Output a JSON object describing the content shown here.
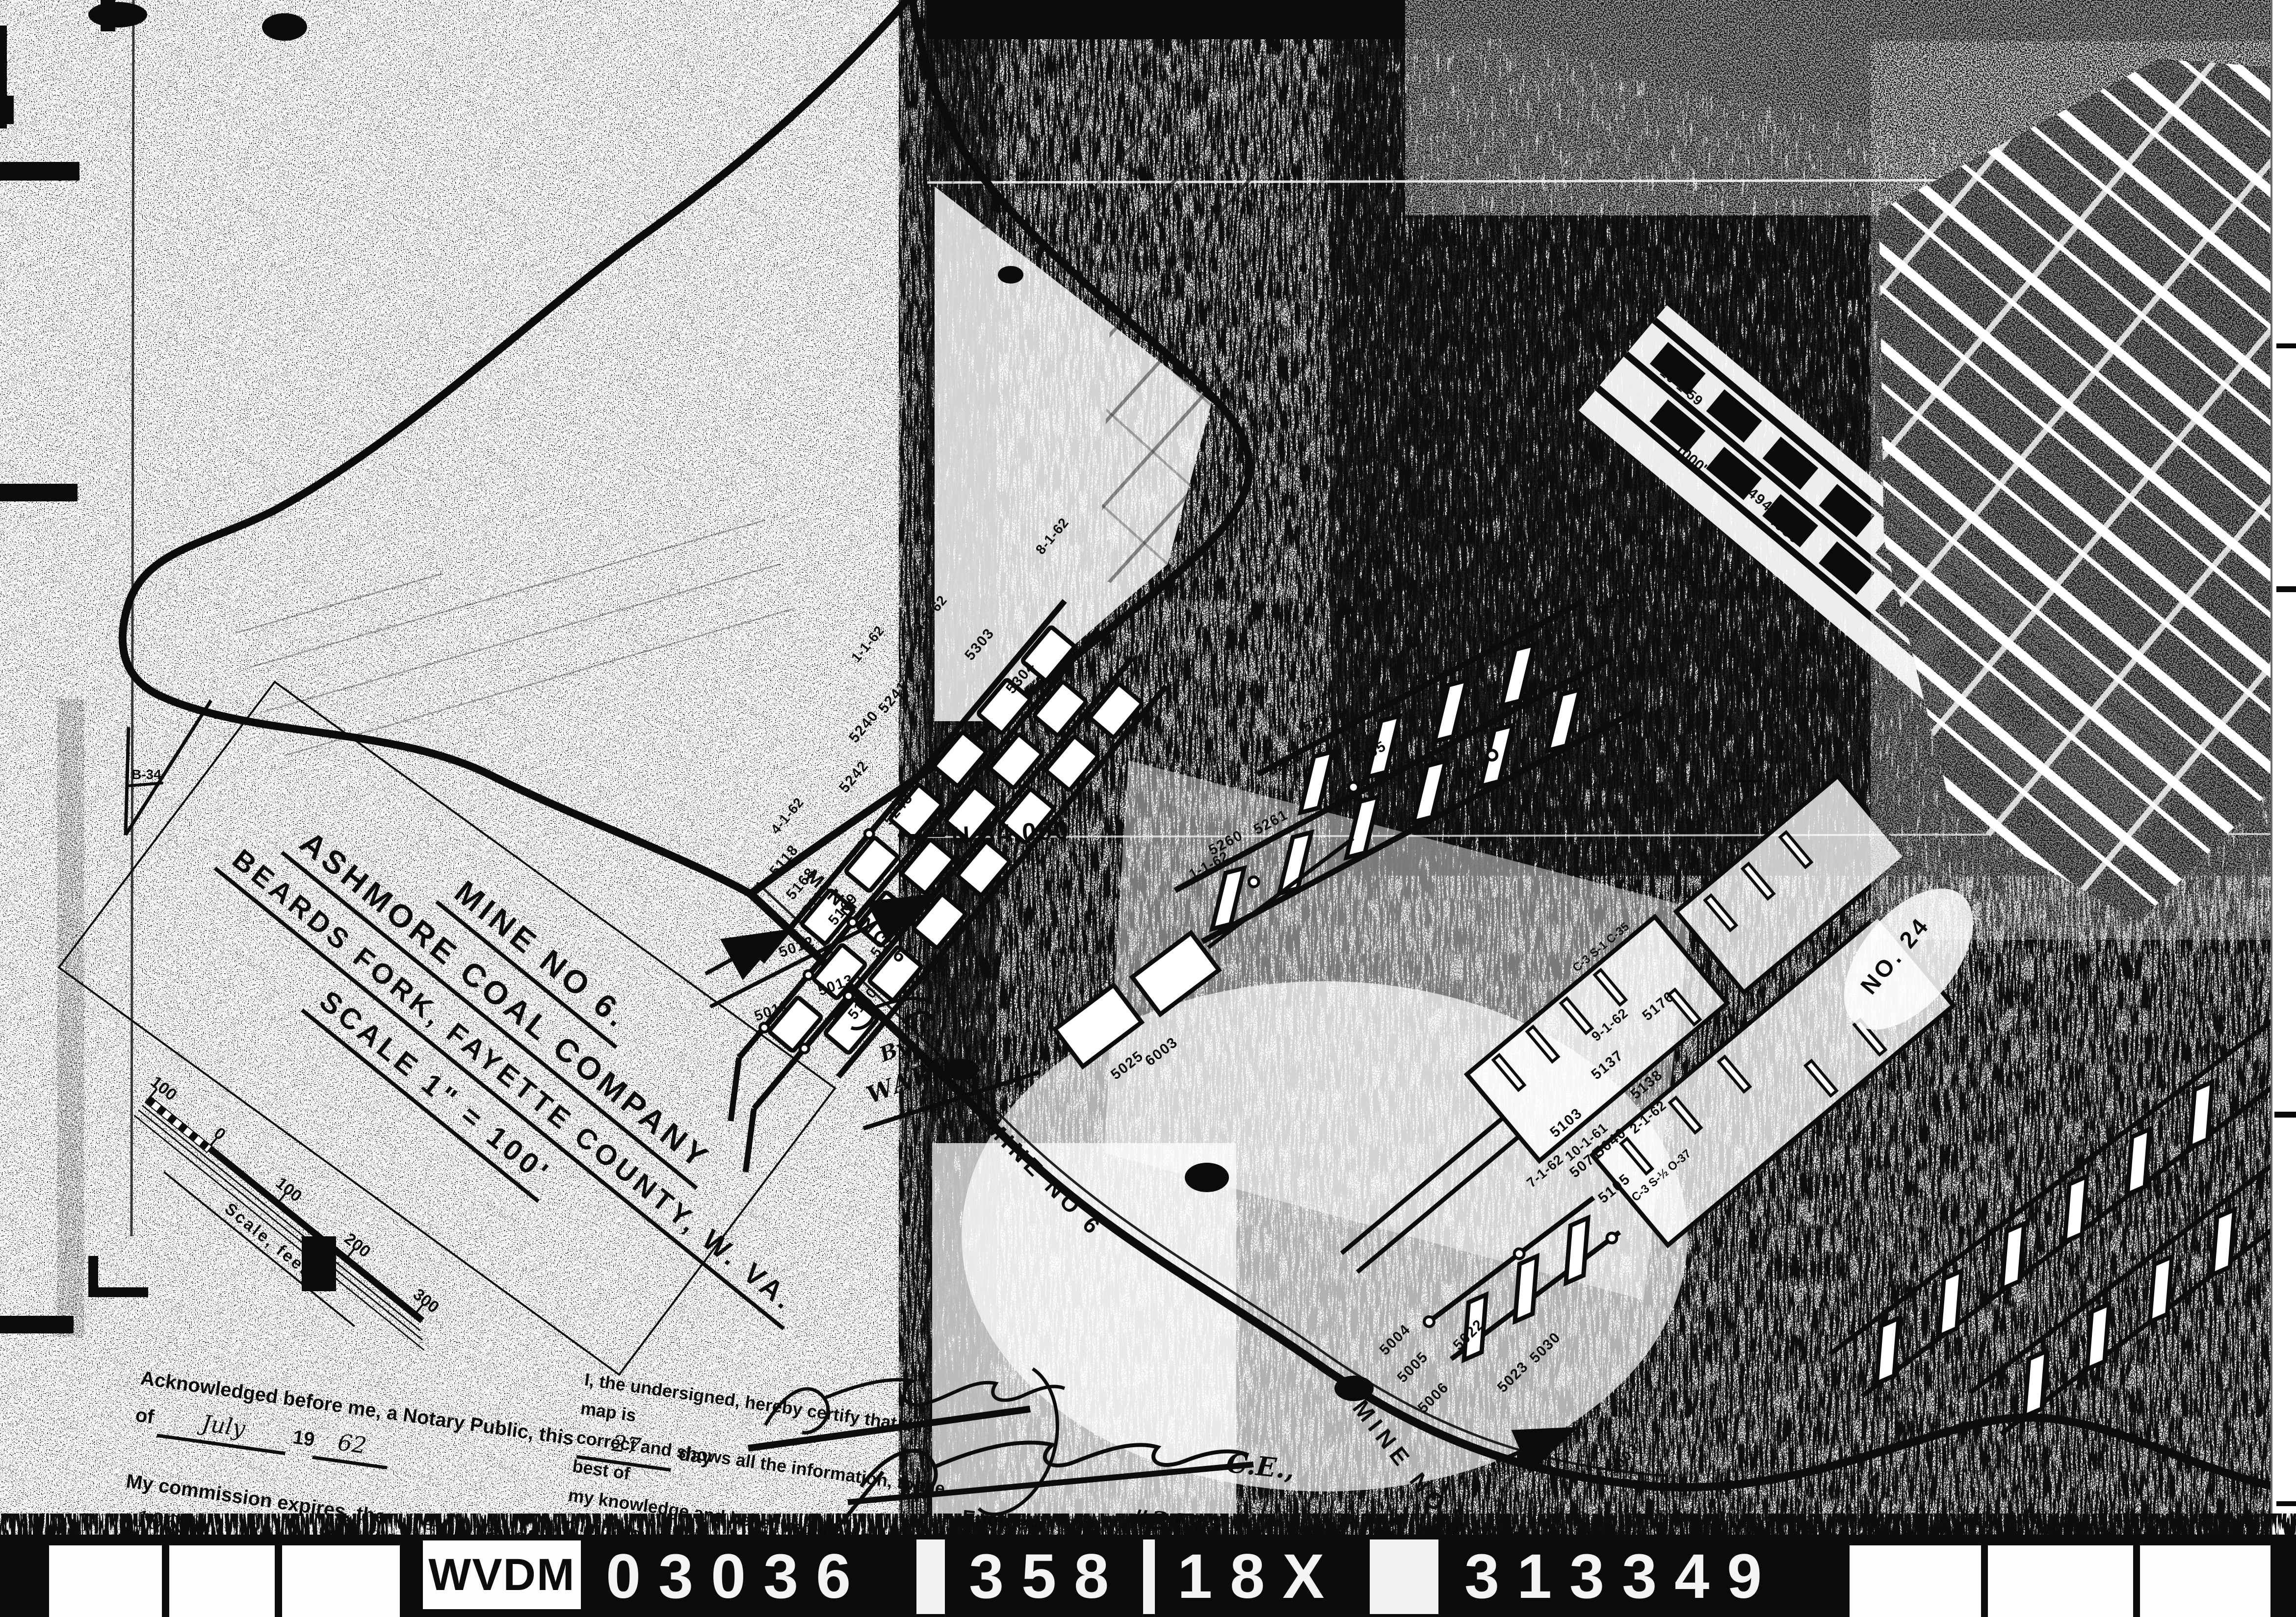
{
  "colors": {
    "ink": "#0b0b0b",
    "paper": "#ffffff"
  },
  "title_block": {
    "lines": [
      "MINE NO 6.",
      "ASHMORE COAL COMPANY",
      "BEARDS FORK, FAYETTE COUNTY, W. VA.",
      "SCALE 1\" = 100'"
    ]
  },
  "scale_bar": {
    "ticks": [
      "100",
      "0",
      "100",
      "200",
      "300"
    ],
    "caption": "Scale, feet"
  },
  "notary": {
    "line1_pre": "Acknowledged before me, a Notary Public, this",
    "day": "27",
    "line1_post": "day",
    "line2_pre": "of",
    "month": "July",
    "year_prefix": "19",
    "year": "62",
    "line3_pre": "My commission expires, the",
    "exp_day": "4",
    "line3_mid": "day of",
    "exp_month": "Dec.",
    "exp_year": "1969"
  },
  "certification": {
    "line1": "I, the undersigned, hereby certify that this map is",
    "line2": "correct and shows all the information, to the best of",
    "line3": "my knowledge and belief, required by the mining laws",
    "line4": "of this State, and covers the period ending",
    "credential": "C.E.,",
    "role": "Engineer",
    "number": "#2135"
  },
  "annotations": {
    "by_ward_line1": "By",
    "by_ward_line2": "WARD",
    "mine6_hand": "MINE NO 6"
  },
  "map_labels": {
    "mine6_haulage": "MINE NO 6",
    "mine5": "MINE NO 5",
    "no24": "NO. 24",
    "northing": "N 34,000",
    "benchmark": "B-34",
    "distance": "1000'"
  },
  "survey_points": [
    "5011",
    "5012",
    "5013",
    "5118",
    "5119",
    "5120",
    "5168",
    "5169",
    "5170",
    "5240",
    "5241",
    "5242",
    "5243",
    "5303",
    "5304",
    "5260",
    "5261",
    "5263",
    "5264",
    "5265",
    "5300",
    "5022",
    "5023",
    "5030",
    "5003",
    "5004",
    "5005",
    "5006",
    "5025",
    "6003",
    "5103",
    "5105",
    "5071",
    "5040",
    "5137",
    "5138",
    "5176",
    "4949",
    "4950"
  ],
  "dates": [
    "1-1-62",
    "4-1-62",
    "8-1-62",
    "9-1-62",
    "10-1-61",
    "2-1-62",
    "7-1-62",
    "10-1-59"
  ],
  "coal_notes": [
    "C-3  S-1  C-35",
    "C-3  S-½  O-37"
  ],
  "film_strip": {
    "cells": [
      "WVDM",
      "03036",
      "358",
      "18X",
      "313349"
    ]
  }
}
